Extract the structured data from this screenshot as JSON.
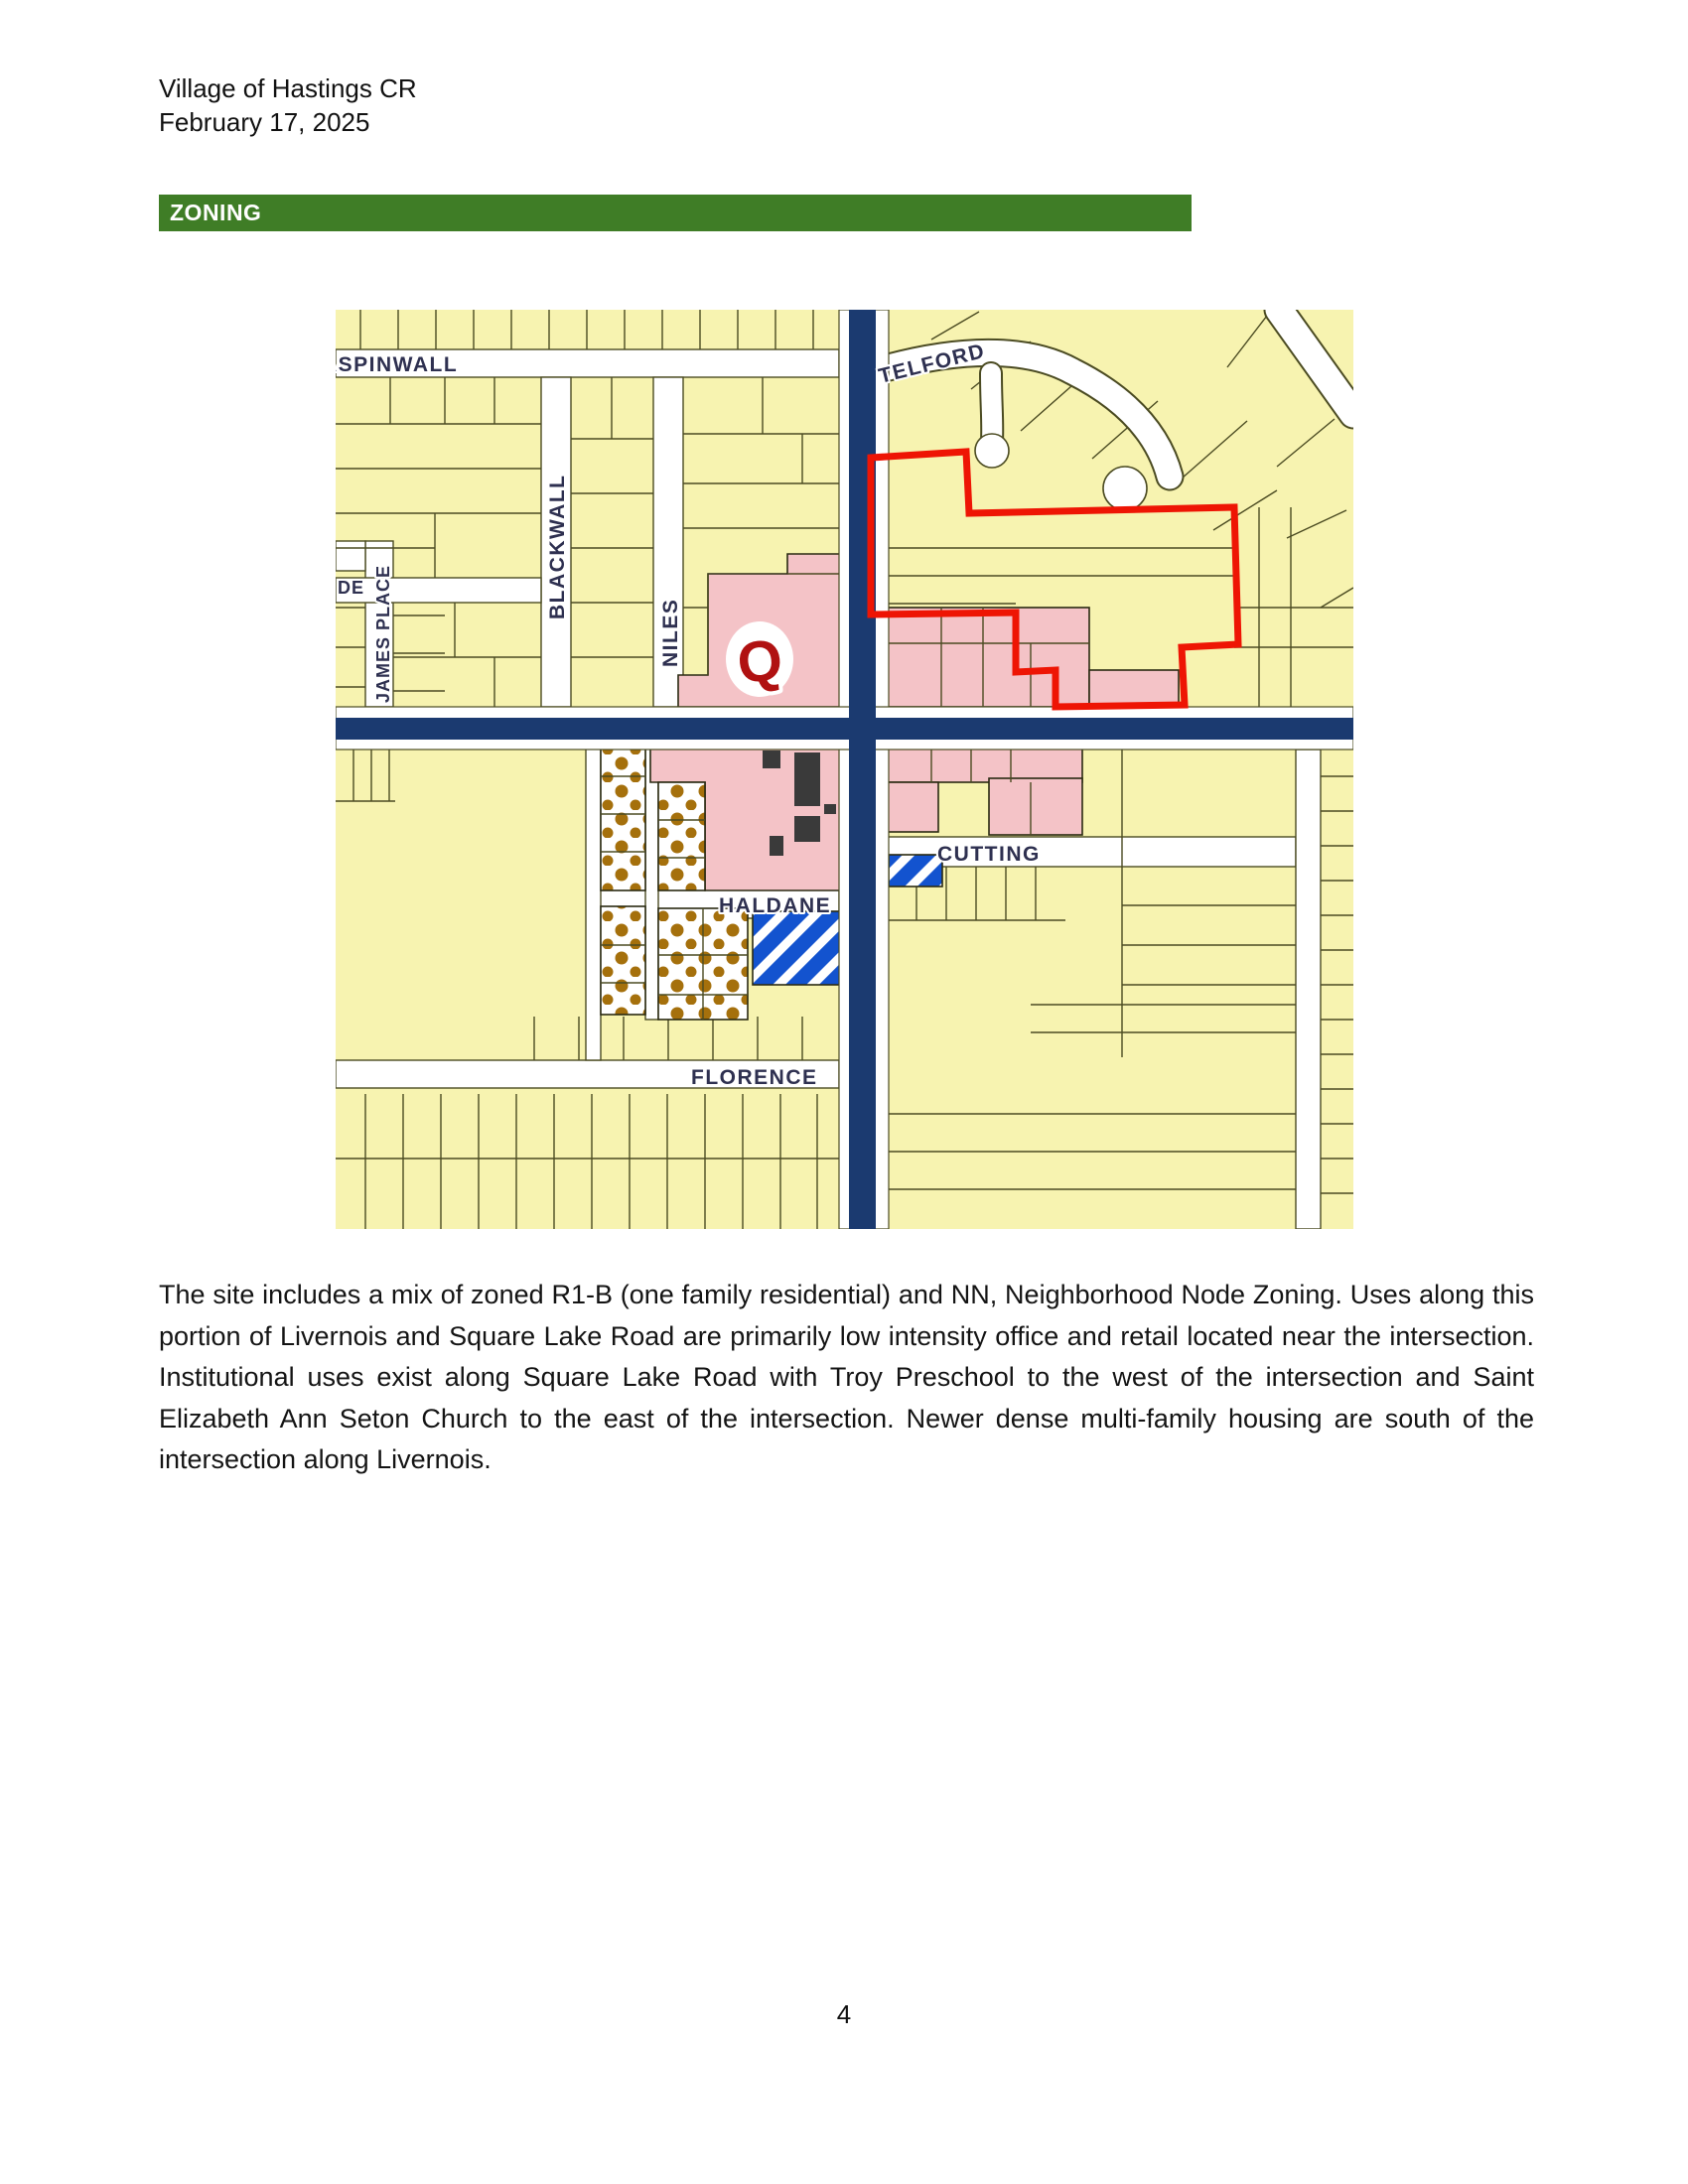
{
  "page": {
    "header_line1": "Village of Hastings CR",
    "header_line2": "February 17, 2025",
    "section_title": "ZONING",
    "page_number": "4"
  },
  "body_paragraph": "The site includes a mix of zoned R1-B (one family residential) and NN, Neighborhood Node Zoning.  Uses along this portion of Livernois and Square Lake Road are primarily low intensity office and retail located near the intersection. Institutional uses exist along Square Lake Road with Troy Preschool to the west of the intersection and Saint Elizabeth Ann Seton Church to the east of the intersection. Newer dense multi-family housing are south of the intersection along Livernois.",
  "map": {
    "labels": {
      "aspinwall": "ASPINWALL",
      "telford": "TELFORD",
      "blackwall": "BLACKWALL",
      "niles": "NILES",
      "james_place": "JAMES PLACE",
      "de_fragment": "DE",
      "cutting": "CUTTING",
      "haldane": "HALDANE",
      "florence": "FLORENCE",
      "q_marker": "Q"
    },
    "colors": {
      "banner_green": "#3f7d26",
      "parcel_yellow": "#f7f3b0",
      "zone_pink": "#f4c3c7",
      "road_navy": "#1b3a70",
      "site_outline_red": "#ee1504",
      "stripe_blue": "#1353cf",
      "dot_brown": "#a5700c",
      "q_red": "#b01111"
    }
  }
}
